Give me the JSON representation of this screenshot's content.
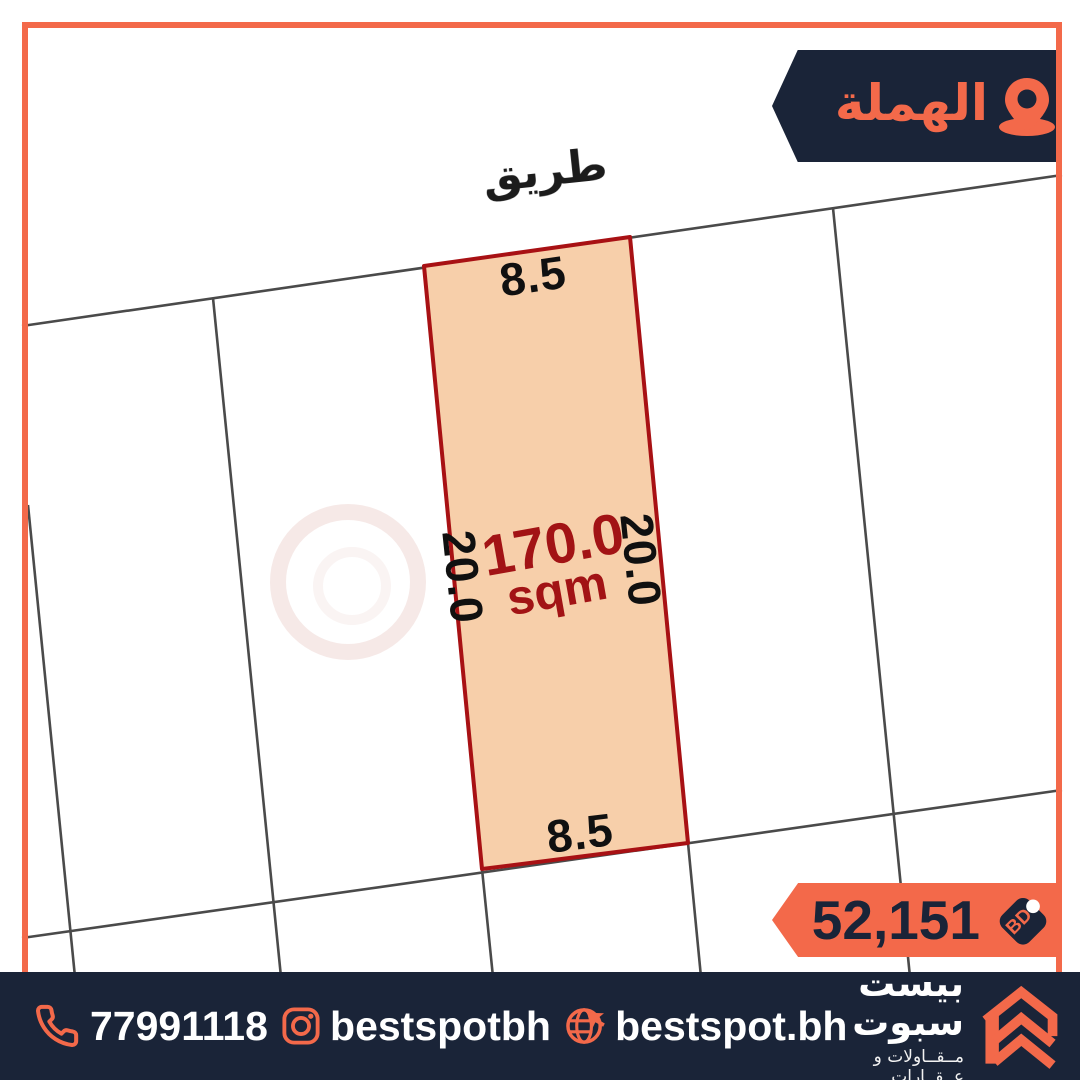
{
  "location_badge": {
    "label": "الهملة"
  },
  "map": {
    "road_label": "طريق",
    "plot": {
      "area_value": "170.0",
      "area_unit": "sqm",
      "width_top": "8.5",
      "width_bottom": "8.5",
      "depth_left": "20.0",
      "depth_right": "20.0"
    }
  },
  "price_badge": {
    "amount": "52,151",
    "currency": "BD"
  },
  "footer": {
    "phone": "77991118",
    "instagram": "bestspotbh",
    "website": "bestspot.bh",
    "company_name": "بيست سبوت",
    "company_tagline": "مــقــاولات و عــقــارات"
  },
  "icons": {
    "location": "map-pin",
    "price": "price-tag",
    "phone": "phone-handset",
    "instagram": "instagram",
    "website": "globe-cursor",
    "logo": "double-chevron-house"
  },
  "colors": {
    "accent_orange": "#f3694a",
    "navy": "#1a2438",
    "plot_fill": "#f7cfaa",
    "plot_border": "#a81114",
    "area_text": "#a21315",
    "parcel_line": "#4a4a4a"
  }
}
